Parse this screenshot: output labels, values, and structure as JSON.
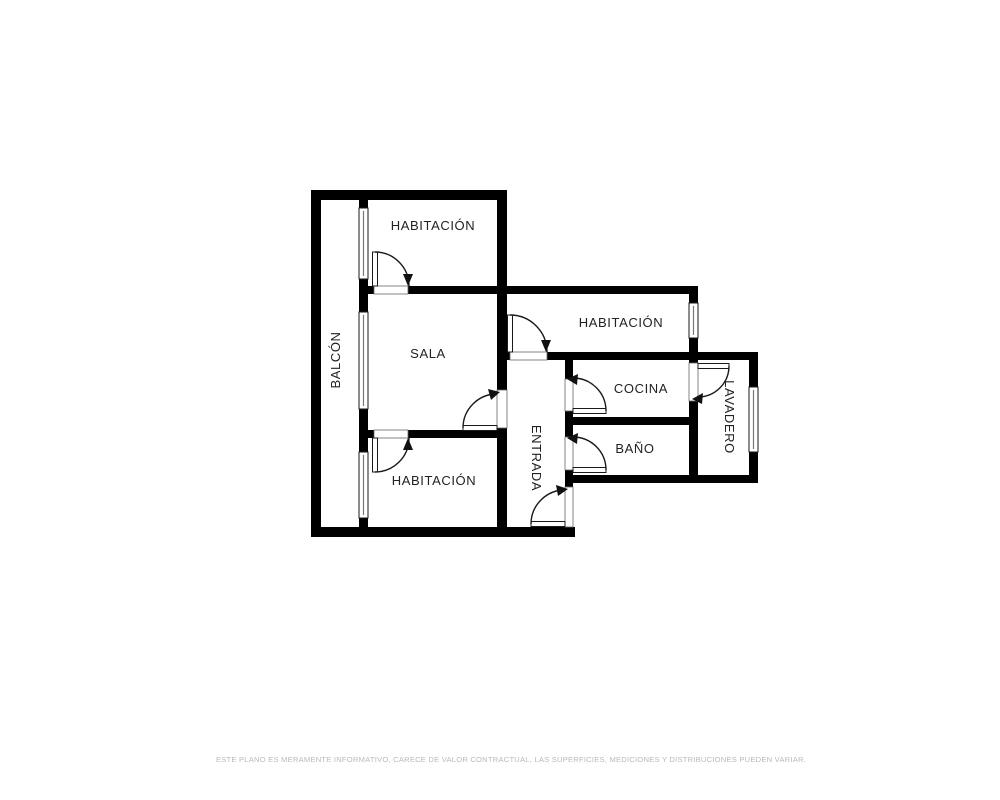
{
  "plan": {
    "type": "floorplan",
    "rooms": [
      {
        "id": "habitacion-top",
        "label": "HABITACIÓN",
        "orientation": "horizontal"
      },
      {
        "id": "balcon",
        "label": "BALCÓN",
        "orientation": "vertical-up"
      },
      {
        "id": "sala",
        "label": "SALA",
        "orientation": "horizontal"
      },
      {
        "id": "habitacion-right",
        "label": "HABITACIÓN",
        "orientation": "horizontal"
      },
      {
        "id": "cocina",
        "label": "COCINA",
        "orientation": "horizontal"
      },
      {
        "id": "entrada",
        "label": "ENTRADA",
        "orientation": "vertical-down"
      },
      {
        "id": "bano",
        "label": "BAÑO",
        "orientation": "horizontal"
      },
      {
        "id": "lavadero",
        "label": "LAVADERO",
        "orientation": "vertical-down"
      },
      {
        "id": "habitacion-bottom",
        "label": "HABITACIÓN",
        "orientation": "horizontal"
      }
    ],
    "features": {
      "windows": 5,
      "doors": 8
    },
    "colors": {
      "wall": "#000000",
      "line": "#1a1a1a",
      "window_mullion": "#777777",
      "label_text": "#222222",
      "disclaimer_text": "#b9b9b9",
      "background": "#ffffff"
    }
  },
  "footer": {
    "disclaimer": "ESTE PLANO ES MERAMENTE INFORMATIVO, CARECE DE VALOR CONTRACTUAL, LAS SUPERFICIES, MEDICIONES Y DISTRIBUCIONES PUEDEN VARIAR."
  }
}
